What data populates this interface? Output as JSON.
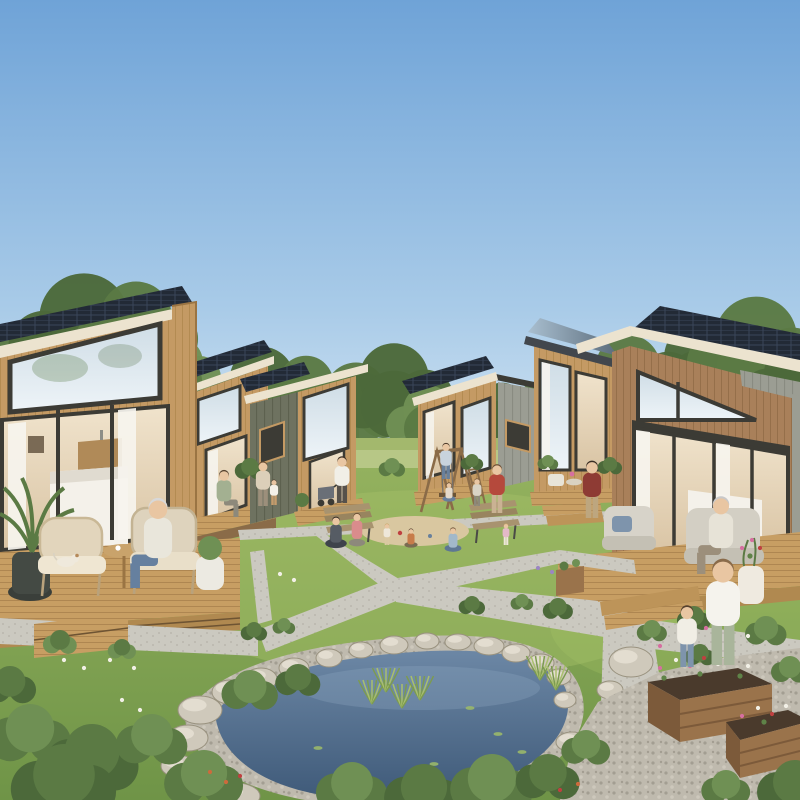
{
  "community": {
    "type": "architectural rendering of a tiny-house eco village",
    "conditions": "clear blue sky, sunny daylight",
    "houses": [
      {
        "id": "house-left-foreground",
        "siding": "light oak vertical wood",
        "roof": "mono-pitch with rooftop solar panels",
        "features": [
          "large trapezoid picture window",
          "full-height glass doors with white curtains",
          "interior bed and kitchenette visible",
          "wood deck with wicker chairs, side table, potted palm",
          "seated elderly resident with small dog"
        ]
      },
      {
        "id": "house-back-left",
        "siding": "light oak wood",
        "roof": "mono-pitch with solar panels",
        "features": [
          "front porch",
          "seated resident"
        ]
      },
      {
        "id": "house-mid-left",
        "siding": "olive-gray battens with wood front",
        "roof": "mono-pitch with solar panels",
        "features": [
          "tall dark-framed windows",
          "small porch with plants"
        ]
      },
      {
        "id": "house-mid-right",
        "siding": "wood front with gray batten wing",
        "roof": "mono-pitch with solar panels",
        "features": [
          "two tall windows",
          "small porch with steps"
        ]
      },
      {
        "id": "house-back-right",
        "siding": "light oak wood",
        "roof": "mono-pitch with reflective solar panels",
        "features": [
          "porch with chairs and flowers",
          "short stair"
        ]
      },
      {
        "id": "house-right-foreground",
        "siding": "walnut wood with light gray wing",
        "roof": "mono-pitch with solar panels and metal seam section",
        "features": [
          "triangular gable window",
          "glass doors with curtains",
          "deck with cushioned armchairs",
          "flower pot",
          "wide steps",
          "seated elderly resident"
        ]
      }
    ],
    "amenities": [
      "central lawn",
      "sand play circle with children",
      "wooden A-frame swing set with ladder",
      "two park benches",
      "garden pond with rock and pebble border",
      "pond reeds and water lilies",
      "raised wooden garden beds with flowers",
      "gravel garden",
      "paved walkway network with X junction",
      "small planter box"
    ],
    "people_count": 19,
    "dog_count": 1
  },
  "palette": {
    "skyTop": "#6fa3d7",
    "skyMid": "#a9cbe8",
    "skyHorizon": "#ddebf6",
    "foliageDark": "#4c693a",
    "foliageMid": "#5b7a44",
    "foliageLight": "#6f9054",
    "trunk": "#8a7355",
    "distantGrass": "#a3b86d",
    "distantGrassLight": "#bcca8c",
    "grassTop": "#93b15e",
    "grassBottom": "#6f9447",
    "grassSun": "#a7c268",
    "path": "#cbc9c0",
    "pathDot": "#b5b2a8",
    "wood": "#c49a64",
    "woodLine": "#ad8449",
    "woodDark": "#8a6b48",
    "woodWalnut": "#a9805a",
    "deck": "#c79e63",
    "deckLine": "#a87f4c",
    "fascia": "#ece3cf",
    "frameDark": "#3c3b35",
    "solar": "#222a36",
    "solarLine": "#3a465a",
    "solarSheen": "#a9bfd0",
    "olive": "#6e7260",
    "oliveLine": "#5d614f",
    "graySiding": "#9b9d93",
    "grayLine": "#898b81",
    "glassTop": "#cfdde6",
    "glassBottom": "#eef4f8",
    "interiorTop": "#f0e3cc",
    "interiorBottom": "#d9c4a4",
    "curtain": "#f6f4ee",
    "waterTop": "#6c87a5",
    "waterDeep": "#3f5a79",
    "pebble": "#bfbaae",
    "pebbleDot": "#a39e92",
    "rock": "#cfc9bb",
    "rockHi": "#e6e0d3",
    "sand": "#d9c7a0",
    "soil": "#4a3a2c",
    "bedWood": "#9a734b",
    "bedWoodDark": "#7c5a3a",
    "skin": "#e9c6a2",
    "reed": "#7c9b50"
  },
  "scene": {
    "trees": [
      {
        "x": 26,
        "y": 436,
        "r": 62,
        "t": 1
      },
      {
        "x": 84,
        "y": 408,
        "r": 72,
        "t": 2
      },
      {
        "x": 136,
        "y": 390,
        "r": 58,
        "t": 1
      },
      {
        "x": 178,
        "y": 412,
        "r": 40,
        "t": 3
      },
      {
        "x": 262,
        "y": 444,
        "r": 52,
        "t": 2
      },
      {
        "x": 306,
        "y": 438,
        "r": 44,
        "t": 1
      },
      {
        "x": 356,
        "y": 456,
        "r": 50,
        "t": 1
      },
      {
        "x": 394,
        "y": 448,
        "r": 56,
        "t": 2
      },
      {
        "x": 428,
        "y": 460,
        "r": 40,
        "t": 3
      },
      {
        "x": 468,
        "y": 455,
        "r": 38,
        "t": 1
      },
      {
        "x": 502,
        "y": 450,
        "r": 36,
        "t": 2
      },
      {
        "x": 540,
        "y": 452,
        "r": 38,
        "t": 1
      },
      {
        "x": 590,
        "y": 442,
        "r": 46,
        "t": 2
      },
      {
        "x": 628,
        "y": 432,
        "r": 52,
        "t": 1
      },
      {
        "x": 700,
        "y": 430,
        "r": 58,
        "t": 2
      },
      {
        "x": 756,
        "y": 420,
        "r": 66,
        "t": 1
      },
      {
        "x": 795,
        "y": 436,
        "r": 50,
        "t": 2
      }
    ],
    "bushes": [
      {
        "x": 30,
        "y": 748,
        "r": 44,
        "t": 1
      },
      {
        "x": 92,
        "y": 774,
        "r": 50,
        "t": 2
      },
      {
        "x": 152,
        "y": 752,
        "r": 38,
        "t": 1
      },
      {
        "x": 64,
        "y": 800,
        "r": 56,
        "t": 2
      },
      {
        "x": 204,
        "y": 792,
        "r": 42,
        "t": 1
      },
      {
        "x": 10,
        "y": 694,
        "r": 28,
        "t": 2
      },
      {
        "x": 250,
        "y": 700,
        "r": 30,
        "t": 1
      },
      {
        "x": 298,
        "y": 688,
        "r": 24,
        "t": 2
      },
      {
        "x": 352,
        "y": 800,
        "r": 38,
        "t": 1
      },
      {
        "x": 424,
        "y": 806,
        "r": 42,
        "t": 2
      },
      {
        "x": 492,
        "y": 798,
        "r": 44,
        "t": 1
      },
      {
        "x": 548,
        "y": 788,
        "r": 34,
        "t": 2
      },
      {
        "x": 586,
        "y": 756,
        "r": 26,
        "t": 1
      },
      {
        "x": 254,
        "y": 636,
        "r": 14,
        "t": 2
      },
      {
        "x": 284,
        "y": 630,
        "r": 12,
        "t": 1
      },
      {
        "x": 472,
        "y": 610,
        "r": 14,
        "t": 2
      },
      {
        "x": 522,
        "y": 606,
        "r": 12,
        "t": 1
      },
      {
        "x": 558,
        "y": 614,
        "r": 16,
        "t": 2
      },
      {
        "x": 652,
        "y": 636,
        "r": 16,
        "t": 1
      },
      {
        "x": 694,
        "y": 624,
        "r": 18,
        "t": 2
      },
      {
        "x": 766,
        "y": 638,
        "r": 22,
        "t": 1
      },
      {
        "x": 60,
        "y": 648,
        "r": 18,
        "t": 3
      },
      {
        "x": 122,
        "y": 654,
        "r": 15,
        "t": 3
      },
      {
        "x": 250,
        "y": 474,
        "r": 16,
        "t": 2
      },
      {
        "x": 392,
        "y": 472,
        "r": 14,
        "t": 1
      },
      {
        "x": 472,
        "y": 466,
        "r": 12,
        "t": 2
      },
      {
        "x": 548,
        "y": 466,
        "r": 11,
        "t": 1
      },
      {
        "x": 610,
        "y": 470,
        "r": 13,
        "t": 2
      },
      {
        "x": 700,
        "y": 660,
        "r": 16,
        "t": 2
      },
      {
        "x": 790,
        "y": 676,
        "r": 20,
        "t": 1
      },
      {
        "x": 795,
        "y": 800,
        "r": 40,
        "t": 2
      },
      {
        "x": 726,
        "y": 796,
        "r": 26,
        "t": 1
      }
    ],
    "rocks": [
      {
        "x": 200,
        "y": 710,
        "rx": 22,
        "ry": 14
      },
      {
        "x": 230,
        "y": 692,
        "rx": 18,
        "ry": 12
      },
      {
        "x": 261,
        "y": 679,
        "rx": 16,
        "ry": 11
      },
      {
        "x": 294,
        "y": 668,
        "rx": 15,
        "ry": 10
      },
      {
        "x": 329,
        "y": 658,
        "rx": 13,
        "ry": 9
      },
      {
        "x": 361,
        "y": 650,
        "rx": 12,
        "ry": 8
      },
      {
        "x": 394,
        "y": 645,
        "rx": 14,
        "ry": 9
      },
      {
        "x": 427,
        "y": 641,
        "rx": 12,
        "ry": 8
      },
      {
        "x": 458,
        "y": 642,
        "rx": 13,
        "ry": 8
      },
      {
        "x": 489,
        "y": 646,
        "rx": 15,
        "ry": 9
      },
      {
        "x": 516,
        "y": 653,
        "rx": 14,
        "ry": 9
      },
      {
        "x": 541,
        "y": 663,
        "rx": 13,
        "ry": 9
      },
      {
        "x": 559,
        "y": 677,
        "rx": 12,
        "ry": 8
      },
      {
        "x": 188,
        "y": 738,
        "rx": 20,
        "ry": 13
      },
      {
        "x": 178,
        "y": 766,
        "rx": 17,
        "ry": 11
      },
      {
        "x": 236,
        "y": 796,
        "rx": 24,
        "ry": 13
      },
      {
        "x": 565,
        "y": 700,
        "rx": 11,
        "ry": 8
      },
      {
        "x": 572,
        "y": 742,
        "rx": 16,
        "ry": 10
      },
      {
        "x": 596,
        "y": 764,
        "rx": 14,
        "ry": 9
      },
      {
        "x": 631,
        "y": 662,
        "rx": 22,
        "ry": 15
      },
      {
        "x": 610,
        "y": 690,
        "rx": 13,
        "ry": 9
      },
      {
        "x": 650,
        "y": 795,
        "rx": 18,
        "ry": 10
      }
    ],
    "people": [
      {
        "id": "elderly-man-left-porch",
        "x": 158,
        "y": 588,
        "h": 88,
        "pose": "seated",
        "dir": -1,
        "shirt": "#e9e6db",
        "pants": "#66809f",
        "hair": "#d8d8d8"
      },
      {
        "id": "woman-house2-porch",
        "x": 224,
        "y": 517,
        "h": 46,
        "pose": "seated",
        "dir": 1,
        "shirt": "#a3b091",
        "pants": "#8d897b",
        "hair": "#55412e"
      },
      {
        "id": "woman-house3-porch",
        "x": 263,
        "y": 506,
        "h": 42,
        "pose": "standing",
        "dir": 1,
        "shirt": "#dccfb9",
        "pants": "#9c8f7b",
        "hair": "#6b4f35"
      },
      {
        "id": "child-house3",
        "x": 274,
        "y": 505,
        "h": 24,
        "pose": "standing",
        "dir": 1,
        "shirt": "#f4f1e8",
        "pants": "#c59c6c",
        "hair": "#4a3828"
      },
      {
        "id": "woman-with-stroller",
        "x": 342,
        "y": 503,
        "h": 44,
        "pose": "standing",
        "dir": -1,
        "shirt": "#f1efe7",
        "pants": "#56514b",
        "hair": "#3a2e24"
      },
      {
        "id": "person-house4-porch",
        "x": 446,
        "y": 479,
        "h": 34,
        "pose": "standing",
        "dir": 1,
        "shirt": "#c8d3dd",
        "pants": "#68809c",
        "hair": "#4a3828"
      },
      {
        "id": "woman-red-shirt",
        "x": 497,
        "y": 513,
        "h": 46,
        "pose": "standing",
        "dir": -1,
        "shirt": "#b5493c",
        "pants": "#cab293",
        "hair": "#6b4f35"
      },
      {
        "id": "man-dark-red",
        "x": 592,
        "y": 518,
        "h": 54,
        "pose": "standing",
        "dir": -1,
        "shirt": "#8e3b34",
        "pants": "#bda67f",
        "hair": "#3a2e24"
      },
      {
        "id": "woman-seated-lawn",
        "x": 336,
        "y": 547,
        "h": 36,
        "pose": "sitting",
        "dir": 1,
        "shirt": "#565c64",
        "pants": "#3e434b",
        "hair": "#2e2620"
      },
      {
        "id": "mother-kneeling",
        "x": 357,
        "y": 545,
        "h": 34,
        "pose": "kneeling",
        "dir": 1,
        "shirt": "#d98c8c",
        "pants": "#8d897b",
        "hair": "#6b4f35"
      },
      {
        "id": "toddler-standing",
        "x": 387,
        "y": 545,
        "h": 20,
        "pose": "standing",
        "dir": -1,
        "shirt": "#eee7d9",
        "pants": "#dbc9a2",
        "hair": "#c9a86b"
      },
      {
        "id": "child-sitting-sand",
        "x": 411,
        "y": 547,
        "h": 22,
        "pose": "sitting",
        "dir": -1,
        "shirt": "#c77b4a",
        "pants": "#7a6b52",
        "hair": "#4a3828"
      },
      {
        "id": "boy-sitting-sand",
        "x": 453,
        "y": 551,
        "h": 28,
        "pose": "sitting",
        "dir": -1,
        "shirt": "#a2b8ca",
        "pants": "#5e7793",
        "hair": "#6b4f35"
      },
      {
        "id": "toddler-pink",
        "x": 506,
        "y": 545,
        "h": 20,
        "pose": "standing",
        "dir": -1,
        "shirt": "#e4b9c7",
        "pants": "#eee7d9",
        "hair": "#c9a86b"
      },
      {
        "id": "child-on-swing",
        "x": 449,
        "y": 501,
        "h": 22,
        "pose": "sitting",
        "dir": 1,
        "shirt": "#e4d9c9",
        "pants": "#68809c",
        "hair": "#4a3828"
      },
      {
        "id": "child-by-ladder",
        "x": 477,
        "y": 506,
        "h": 26,
        "pose": "standing",
        "dir": -1,
        "shirt": "#d9d3c5",
        "pants": "#8d897b",
        "hair": "#6b4f35"
      },
      {
        "id": "elderly-man-right-porch",
        "x": 721,
        "y": 574,
        "h": 76,
        "pose": "seated",
        "dir": -1,
        "shirt": "#e7e3d7",
        "pants": "#9c8f7b",
        "hair": "#c9c9c9"
      },
      {
        "id": "woman-gardening",
        "x": 723,
        "y": 665,
        "h": 100,
        "pose": "standing",
        "dir": -1,
        "shirt": "#f5f3ed",
        "pants": "#a9b59b",
        "hair": "#8a6b4a"
      },
      {
        "id": "girl-gardening",
        "x": 687,
        "y": 667,
        "h": 58,
        "pose": "standing",
        "dir": 1,
        "shirt": "#f1eee5",
        "pants": "#7e94ac",
        "hair": "#55412e"
      }
    ],
    "dog": {
      "x": 66,
      "y": 562
    },
    "flowers": [
      {
        "x": 660,
        "y": 668,
        "c": "p"
      },
      {
        "x": 676,
        "y": 660,
        "c": "w"
      },
      {
        "x": 690,
        "y": 666,
        "c": "p"
      },
      {
        "x": 704,
        "y": 658,
        "c": "r"
      },
      {
        "x": 718,
        "y": 664,
        "c": "w"
      },
      {
        "x": 732,
        "y": 658,
        "c": "p"
      },
      {
        "x": 748,
        "y": 666,
        "c": "w"
      },
      {
        "x": 700,
        "y": 674,
        "c": "g"
      },
      {
        "x": 664,
        "y": 678,
        "c": "g"
      },
      {
        "x": 740,
        "y": 676,
        "c": "g"
      },
      {
        "x": 742,
        "y": 716,
        "c": "p"
      },
      {
        "x": 758,
        "y": 708,
        "c": "w"
      },
      {
        "x": 772,
        "y": 714,
        "c": "r"
      },
      {
        "x": 786,
        "y": 706,
        "c": "w"
      },
      {
        "x": 764,
        "y": 722,
        "c": "g"
      },
      {
        "x": 742,
        "y": 548,
        "c": "p"
      },
      {
        "x": 752,
        "y": 540,
        "c": "p"
      },
      {
        "x": 760,
        "y": 548,
        "c": "r"
      },
      {
        "x": 750,
        "y": 556,
        "c": "g"
      },
      {
        "x": 64,
        "y": 660,
        "c": "w"
      },
      {
        "x": 84,
        "y": 668,
        "c": "w"
      },
      {
        "x": 110,
        "y": 660,
        "c": "w"
      },
      {
        "x": 134,
        "y": 668,
        "c": "w"
      },
      {
        "x": 280,
        "y": 574,
        "c": "w"
      },
      {
        "x": 294,
        "y": 580,
        "c": "w"
      },
      {
        "x": 538,
        "y": 568,
        "c": "v"
      },
      {
        "x": 552,
        "y": 572,
        "c": "v"
      },
      {
        "x": 660,
        "y": 646,
        "c": "p"
      },
      {
        "x": 680,
        "y": 640,
        "c": "w"
      },
      {
        "x": 706,
        "y": 628,
        "c": "p"
      },
      {
        "x": 748,
        "y": 636,
        "c": "w"
      },
      {
        "x": 210,
        "y": 772,
        "c": "o"
      },
      {
        "x": 226,
        "y": 782,
        "c": "o"
      },
      {
        "x": 240,
        "y": 776,
        "c": "r"
      },
      {
        "x": 560,
        "y": 790,
        "c": "r"
      },
      {
        "x": 578,
        "y": 784,
        "c": "o"
      },
      {
        "x": 122,
        "y": 700,
        "c": "w"
      },
      {
        "x": 140,
        "y": 710,
        "c": "w"
      }
    ],
    "flowerColors": {
      "p": "#d66fa0",
      "w": "#f2f0e6",
      "r": "#bf4040",
      "g": "#5f8348",
      "o": "#cd6a3c",
      "v": "#9b86c2"
    },
    "reeds": [
      {
        "x": 372,
        "y": 704
      },
      {
        "x": 386,
        "y": 692
      },
      {
        "x": 402,
        "y": 708
      },
      {
        "x": 420,
        "y": 700
      },
      {
        "x": 540,
        "y": 680
      },
      {
        "x": 556,
        "y": 690
      }
    ],
    "lilies": [
      {
        "x": 470,
        "y": 708
      },
      {
        "x": 498,
        "y": 734
      },
      {
        "x": 318,
        "y": 748
      },
      {
        "x": 434,
        "y": 764
      },
      {
        "x": 522,
        "y": 752
      }
    ]
  }
}
